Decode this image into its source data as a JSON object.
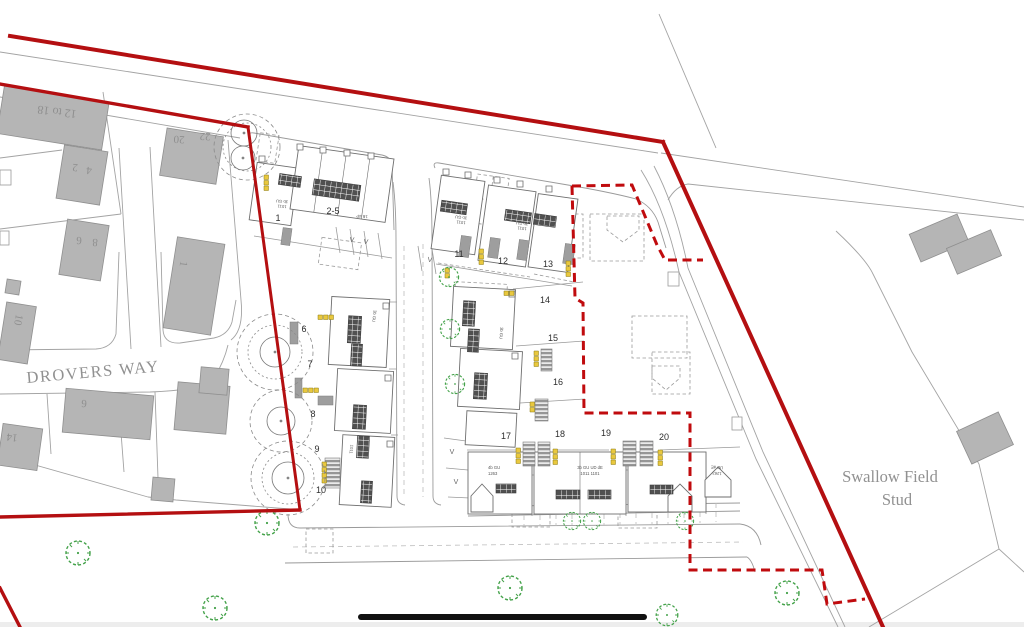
{
  "map": {
    "road_label": "DROVERS WAY",
    "area_label": {
      "line1": "Swallow Field",
      "line2": "Stud"
    }
  },
  "existing_numbers": {
    "n12to18": "12 to 18",
    "n22": "22",
    "n20": "20",
    "n2": "2",
    "n4": "4",
    "n6": "6",
    "n8": "8",
    "n10": "10",
    "n1": "1",
    "n6s": "6",
    "n14": "14"
  },
  "plots": {
    "p1": "1",
    "p2to5": "2-5",
    "p6": "6",
    "p7": "7",
    "p8": "8",
    "p9": "9",
    "p10": "10",
    "p11": "11",
    "p12": "12",
    "p13": "13",
    "p14": "14",
    "p15": "15",
    "p16": "16",
    "p17": "17",
    "p18": "18",
    "p19": "19",
    "p20": "20"
  },
  "annotations": {
    "t3b": "3b GU",
    "r1011": "1011",
    "t4b": "4b GU",
    "r1263": "1263",
    "tmix": "3b GU  UD dE",
    "rmix": "1011  1101",
    "tud": "UD dE",
    "t1b4p": "1B 4P",
    "visitor": "V"
  },
  "colors": {
    "boundary_red": "#b40f11",
    "tree_green": "#44a24a",
    "building_grey": "#b5b5b5",
    "marker_yellow": "#e9c83e",
    "panel_dark": "#505050",
    "text_grey": "#8f8f8f"
  }
}
